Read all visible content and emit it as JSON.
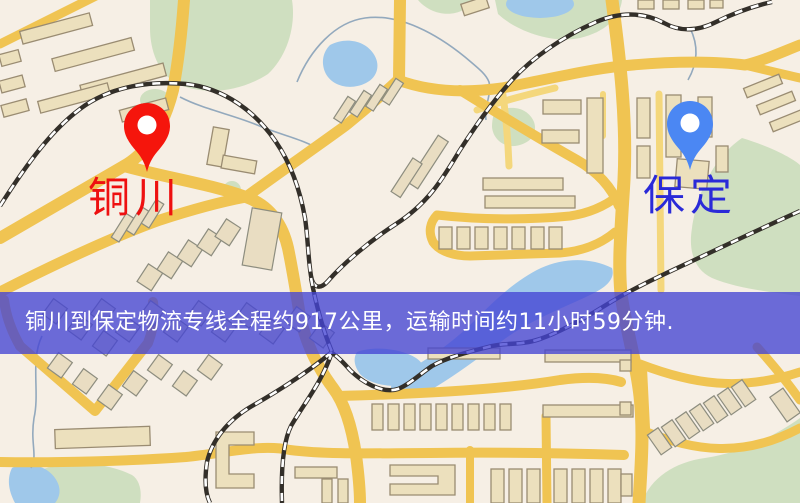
{
  "route_banner": {
    "text": "铜川到保定物流专线全程约917公里，运输时间约11小时59分钟.",
    "origin": "铜川",
    "destination": "保定",
    "distance_text": "约917公里",
    "duration_text": "约11小时59分钟",
    "bg_color": "rgba(68,68,212,0.78)",
    "text_color": "#ffffff"
  },
  "markers": {
    "origin": {
      "label": "铜川",
      "pin_color": "#f5150c",
      "label_color": "#ee1010"
    },
    "destination": {
      "label": "保定",
      "pin_color": "#4b87f3",
      "label_color": "#2a2ad8"
    }
  },
  "map_palette": {
    "background": "#f6efe5",
    "road_major": "#f0c452",
    "road_minor": "#f4d77c",
    "building_fill": "#ece0bd",
    "building_outline": "#9a8c72",
    "park_green": "#cfdfc0",
    "water_blue": "#9fc8ea",
    "railway_dark": "#332f29",
    "stream_gray": "#93a9bd"
  }
}
